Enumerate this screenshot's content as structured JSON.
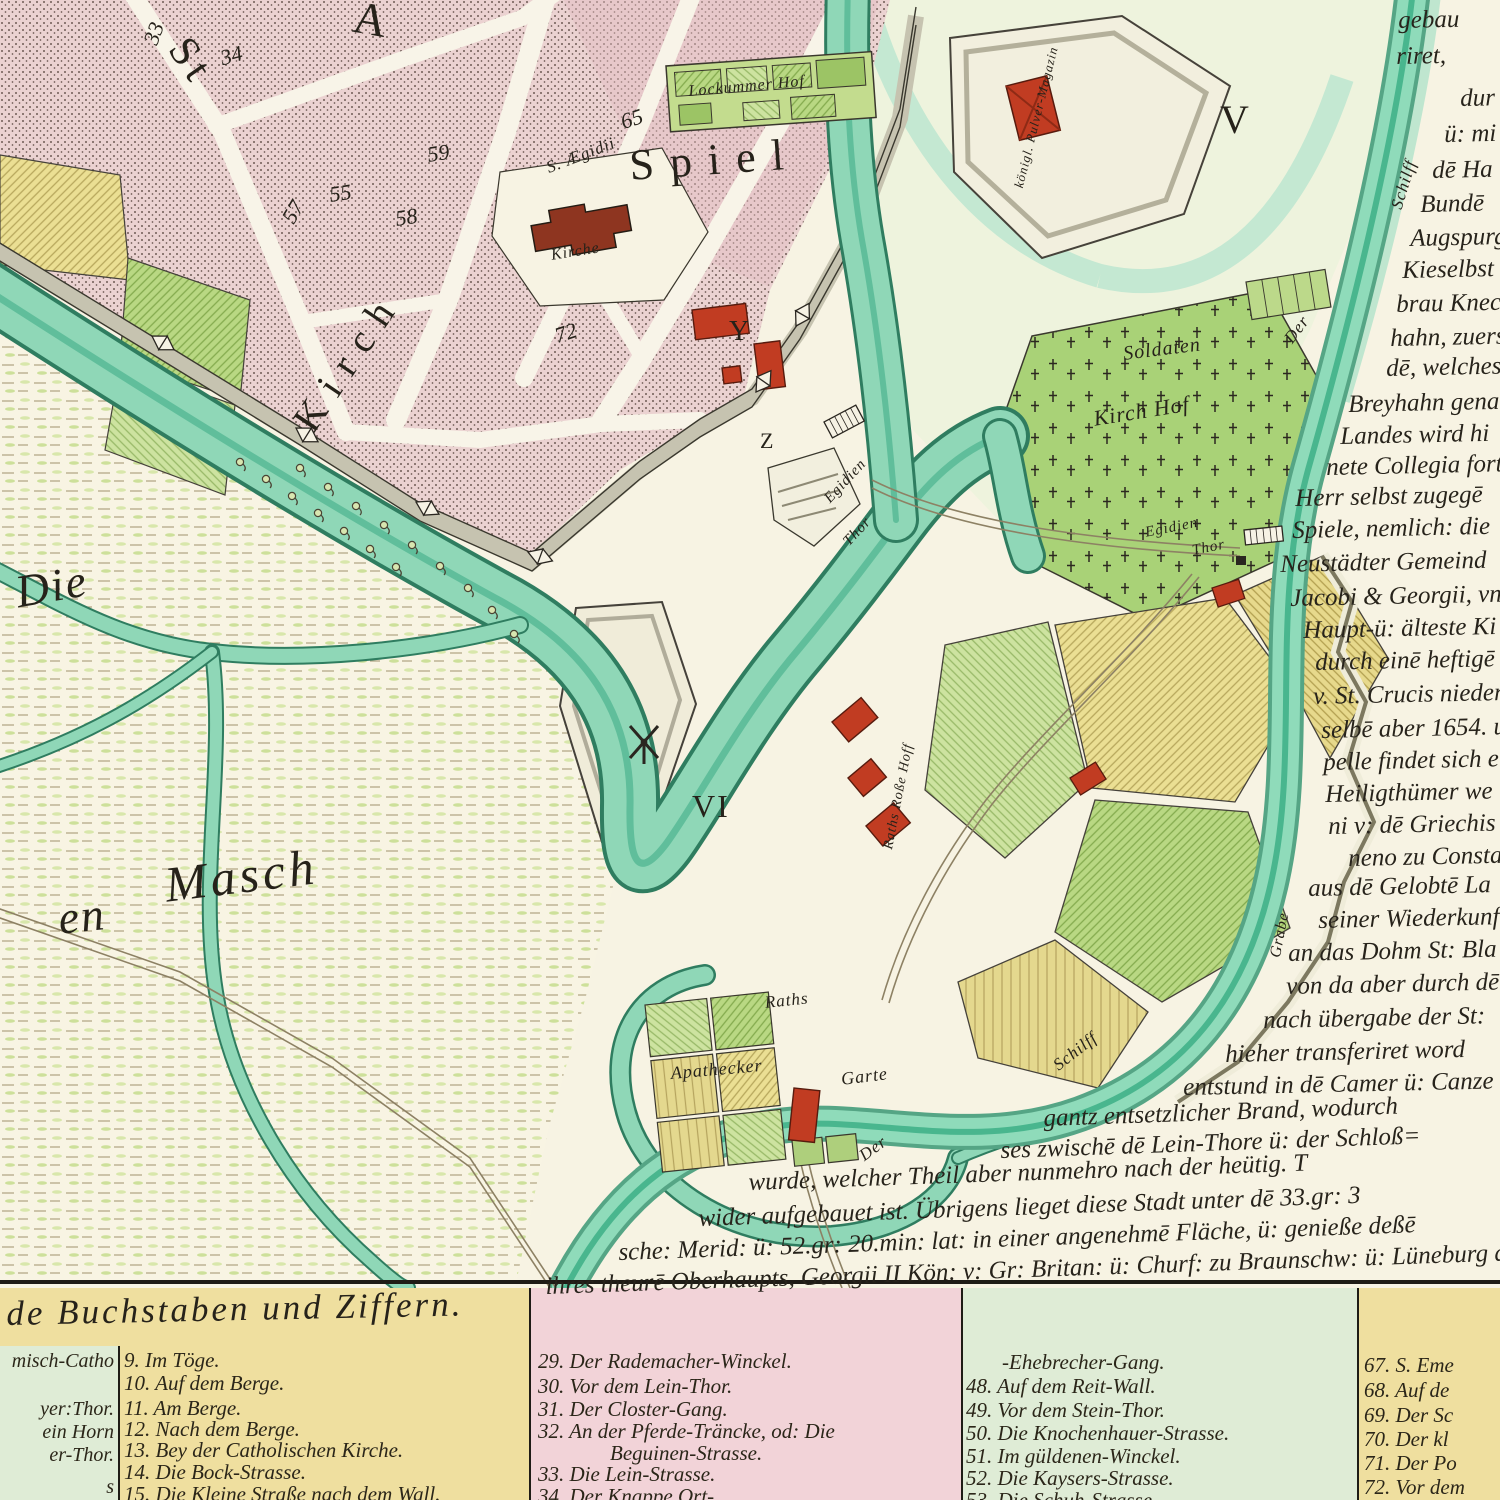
{
  "map": {
    "big_labels": {
      "st": "St",
      "a": "A",
      "spiel": "Spiel",
      "kirch": "Kirch",
      "v": "V",
      "vi": "VI",
      "y": "Y",
      "z": "Z",
      "die": "Die",
      "en": "en",
      "masch": "Masch"
    },
    "numbers": [
      "33",
      "34",
      "55",
      "57",
      "58",
      "59",
      "65",
      "72"
    ],
    "places": {
      "lockummer_hof": "Lockummer Hof",
      "pulver_magazin": "königl. Pulver-Magazin",
      "s_aegidii": "S. Ægidii",
      "kirche": "Kirche",
      "soldaten": "Soldaten",
      "kirch_hof": "Kirch Hof",
      "egidien_thor_inner_1": "Egidien",
      "egidien_thor_inner_2": "Thor",
      "egidien_thor_outer_1": "Egidien",
      "egidien_thor_outer_2": "Thor",
      "raths_rosse_hoff": "Raths Roße Hoff",
      "raths": "Raths",
      "apathecker": "Apathecker",
      "garte": "Garte",
      "der_upper": "Der",
      "schilff_upper": "Schilff",
      "grabe": "Grabe",
      "der_lower": "Der",
      "schilff_lower": "Schilff"
    },
    "icons": {
      "windmill": "windmill-icon",
      "bridge": "bridge-icon",
      "gate": "gate-bowtie-icon",
      "shrub": "shrub-icon",
      "grave_cross": "cross-icon"
    }
  },
  "right_text": {
    "lines": [
      "gebau",
      "riret,",
      "dur",
      "ü: mi",
      "dē Ha",
      "Bundē",
      "Augspurg",
      "Kieselbst is",
      "brau Knech",
      "hahn, zuerst",
      "dē, welches, ih",
      "Breyhahn gena",
      "Landes wird hi",
      "nete Collegia forti",
      "Herr selbst zugegē",
      "Spiele, nemlich: die",
      "Neustädter Gemeind",
      "Jacobi & Georgii, vn",
      "Haupt-ü: älteste Ki",
      "durch einē heftigē",
      "v. St. Crucis nieder",
      "selbē aber 1654. u",
      "pelle findet sich e",
      "Heiligthümer we",
      "ni v: dē Griechis",
      "neno zu Constanti",
      "aus dē Gelobtē La",
      "seiner Wiederkunft",
      "an das Dohm St: Bla",
      "von da aber durch dē",
      "nach übergabe der St:",
      "hieher transferiret word",
      "entstund in dē Camer ü: Canze",
      "gantz entsetzlicher Brand, wodurch",
      "ses zwischē dē Lein-Thore ü: der Schloß=",
      "wurde, welcher Theil aber nunmehro nach der heütig. T",
      "wider aufgebauet ist. Übrigens lieget diese Stadt unter dē 33.gr: 3",
      "sche: Merid: ü: 52.gr: 20.min: lat: in einer angenehmē Fläche, ü: genieße deßē",
      "ihres theurē Oberhaupts, Georgii II Kön: v: Gr: Britan: ü: Churf: zu Braunschw: ü: Lüneburg alle e"
    ]
  },
  "legend": {
    "title": "de Buchstaben und Ziffern.",
    "col_a": [
      "misch-Catho",
      "yer:Thor.",
      "ein Horn",
      "er-Thor.",
      "s"
    ],
    "col_b": [
      "9. Im Töge.",
      "10. Auf dem Berge.",
      "11. Am Berge.",
      "12. Nach dem Berge.",
      "13. Bey der Catholischen Kirche.",
      "14. Die Bock-Strasse.",
      "15. Die Kleine Straße nach dem Wall."
    ],
    "col_c": [
      "29. Der Rademacher-Winckel.",
      "30. Vor dem Lein-Thor.",
      "31. Der Closter-Gang.",
      "32. An der Pferde-Träncke, od: Die",
      "Beguinen-Strasse.",
      "33. Die Lein-Strasse.",
      "34. Der Knappe Ort-"
    ],
    "col_d": [
      "-Ehebrecher-Gang.",
      "48. Auf dem Reit-Wall.",
      "49. Vor dem Stein-Thor.",
      "50. Die Knochenhauer-Strasse.",
      "51. Im güldenen-Winckel.",
      "52. Die Kaysers-Strasse.",
      "53. Die Schuh-Strasse"
    ],
    "col_e": [
      "67. S. Eme",
      "68. Auf de",
      "69. Der Sc",
      "70. Der kl",
      "71. Der Po",
      "72. Vor dem"
    ]
  },
  "colors": {
    "paper": "#f7f3e3",
    "water": "#8fd7b7",
    "water_dark": "#2f7d60",
    "city_pink": "#ebd2d1",
    "building_red": "#c13c22",
    "church_red": "#8e3520",
    "field_green": "#b9d883",
    "field_yellow": "#ebdf93",
    "legend_yellow": "#efdf9f",
    "legend_pink": "#f2d3d8",
    "legend_green": "#dfecd6",
    "ink": "#27231b"
  }
}
